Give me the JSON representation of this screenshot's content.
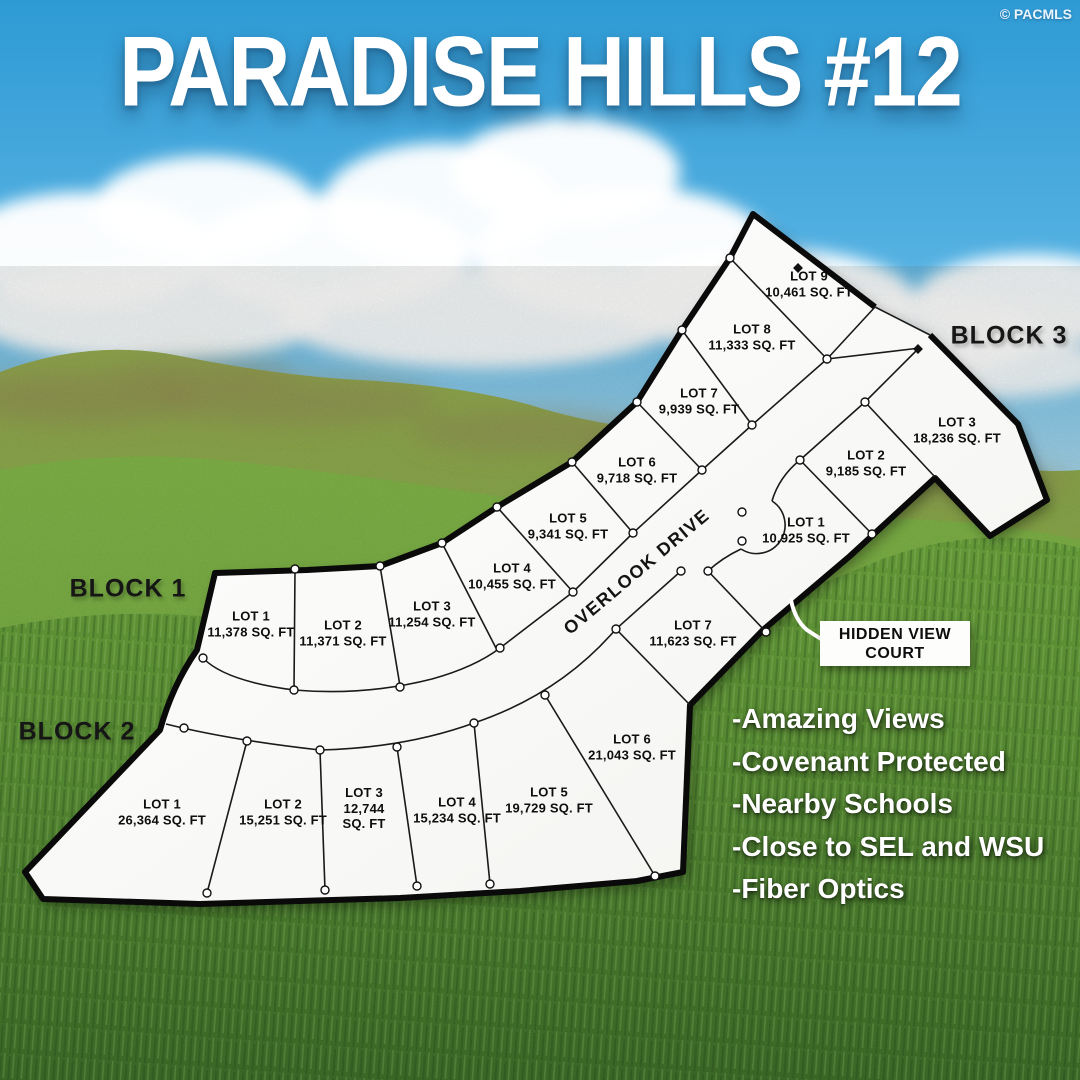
{
  "title": "PARADISE HILLS #12",
  "watermark": "© PACMLS",
  "blocks": {
    "b1": {
      "label": "BLOCK 1"
    },
    "b2": {
      "label": "BLOCK 2"
    },
    "b3": {
      "label": "BLOCK 3"
    }
  },
  "roads": {
    "overlook_drive": "OVERLOOK DRIVE",
    "hidden_view_court_line1": "HIDDEN VIEW",
    "hidden_view_court_line2": "COURT"
  },
  "lots": {
    "block1": [
      {
        "name": "LOT 1",
        "area": "11,378 SQ. FT"
      },
      {
        "name": "LOT 2",
        "area": "11,371 SQ. FT"
      },
      {
        "name": "LOT 3",
        "area": "11,254 SQ. FT"
      },
      {
        "name": "LOT 4",
        "area": "10,455 SQ. FT"
      },
      {
        "name": "LOT 5",
        "area": "9,341 SQ. FT"
      },
      {
        "name": "LOT 6",
        "area": "9,718 SQ. FT"
      },
      {
        "name": "LOT 7",
        "area": "9,939 SQ. FT"
      },
      {
        "name": "LOT 8",
        "area": "11,333 SQ. FT"
      },
      {
        "name": "LOT 9",
        "area": "10,461 SQ. FT"
      }
    ],
    "block2": [
      {
        "name": "LOT 1",
        "area": "26,364 SQ. FT"
      },
      {
        "name": "LOT 2",
        "area": "15,251 SQ. FT"
      },
      {
        "name": "LOT 3",
        "area": "12,744 SQ. FT"
      },
      {
        "name": "LOT 4",
        "area": "15,234 SQ. FT"
      },
      {
        "name": "LOT 5",
        "area": "19,729 SQ. FT"
      },
      {
        "name": "LOT 6",
        "area": "21,043 SQ. FT"
      },
      {
        "name": "LOT 7",
        "area": "11,623 SQ. FT"
      }
    ],
    "block3": [
      {
        "name": "LOT 1",
        "area": "10,925 SQ. FT"
      },
      {
        "name": "LOT 2",
        "area": "9,185 SQ. FT"
      },
      {
        "name": "LOT 3",
        "area": "18,236 SQ. FT"
      }
    ]
  },
  "features": [
    "-Amazing Views",
    "-Covenant Protected",
    "-Nearby Schools",
    "-Close to SEL and WSU",
    "-Fiber Optics"
  ],
  "colors": {
    "sky_top": "#2e9ad4",
    "sky_horizon": "#b9e2f4",
    "hill_far": "#8ca544",
    "hill_mid": "#6cab35",
    "grass_dark": "#2f6519",
    "plat_fill": "#ffffff",
    "plat_outline": "#0a0a0a"
  }
}
